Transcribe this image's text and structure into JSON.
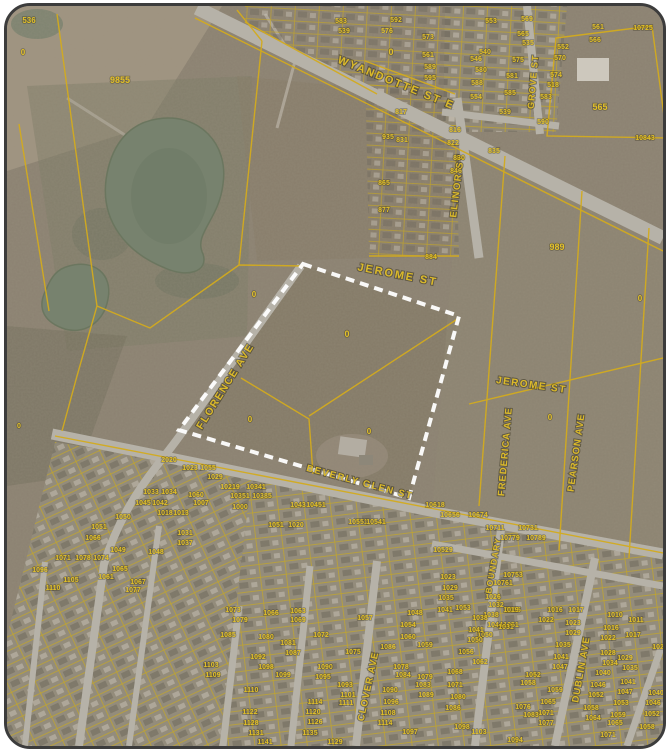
{
  "map": {
    "colors": {
      "base": "#8b8171",
      "parcel_line": "#d3ab1e",
      "label": "#e2c028",
      "street_label": "#dcba2a",
      "selection_boundary": "#ffffff",
      "road": "#b6b2a8",
      "pond": "#77826e",
      "subdivision_ground": "#96907f",
      "frame_border": "#3c3c3c"
    },
    "street_labels": [
      {
        "t": "WYANDOTTE ST E",
        "x": 388,
        "y": 80,
        "a": 22,
        "s": 11,
        "ls": 2
      },
      {
        "t": "ELINOR ST",
        "x": 453,
        "y": 180,
        "a": -83,
        "s": 9.5,
        "ls": 1.5
      },
      {
        "t": "GROVE ST",
        "x": 529,
        "y": 76,
        "a": -85,
        "s": 9,
        "ls": 1
      },
      {
        "t": "JEROME ST",
        "x": 390,
        "y": 272,
        "a": 11,
        "s": 11,
        "ls": 2
      },
      {
        "t": "JEROME ST",
        "x": 524,
        "y": 382,
        "a": 8,
        "s": 10,
        "ls": 1.5
      },
      {
        "t": "FLORENCE AVE",
        "x": 221,
        "y": 382,
        "a": -58,
        "s": 10.5,
        "ls": 1.5
      },
      {
        "t": "FREDERICA AVE",
        "x": 501,
        "y": 446,
        "a": -85,
        "s": 9.5,
        "ls": 1
      },
      {
        "t": "PEARSON AVE",
        "x": 572,
        "y": 447,
        "a": -82,
        "s": 9.5,
        "ls": 1
      },
      {
        "t": "BEVERLY GLEN ST",
        "x": 352,
        "y": 479,
        "a": 15,
        "s": 9.5,
        "ls": 1.5
      },
      {
        "t": "BOUNDARY",
        "x": 489,
        "y": 560,
        "a": -80,
        "s": 8.5,
        "ls": 1
      },
      {
        "t": "CLOVER AVE",
        "x": 364,
        "y": 681,
        "a": -78,
        "s": 9.5,
        "ls": 1
      },
      {
        "t": "DUBLIN AVE",
        "x": 577,
        "y": 664,
        "a": -80,
        "s": 9.5,
        "ls": 1
      }
    ],
    "parcel_labels": [
      {
        "t": "536",
        "x": 22,
        "y": 17,
        "s": 8
      },
      {
        "t": "0",
        "x": 16,
        "y": 49,
        "s": 8
      },
      {
        "t": "9855",
        "x": 113,
        "y": 77,
        "s": 9
      },
      {
        "t": "0",
        "x": 12,
        "y": 422,
        "s": 7
      },
      {
        "t": "0",
        "x": 384,
        "y": 49,
        "s": 9
      },
      {
        "t": "0",
        "x": 340,
        "y": 331,
        "s": 9
      },
      {
        "t": "0",
        "x": 247,
        "y": 291,
        "s": 8
      },
      {
        "t": "0",
        "x": 243,
        "y": 416,
        "s": 8
      },
      {
        "t": "0",
        "x": 362,
        "y": 428,
        "s": 8
      },
      {
        "t": "0",
        "x": 543,
        "y": 414,
        "s": 8
      },
      {
        "t": "0",
        "x": 633,
        "y": 295,
        "s": 8
      },
      {
        "t": "989",
        "x": 550,
        "y": 244,
        "s": 9
      },
      {
        "t": "565",
        "x": 593,
        "y": 104,
        "s": 9
      },
      {
        "t": "583",
        "x": 334,
        "y": 17
      },
      {
        "t": "539",
        "x": 337,
        "y": 27
      },
      {
        "t": "592",
        "x": 389,
        "y": 16
      },
      {
        "t": "576",
        "x": 380,
        "y": 27
      },
      {
        "t": "573",
        "x": 421,
        "y": 33
      },
      {
        "t": "561",
        "x": 421,
        "y": 51
      },
      {
        "t": "589",
        "x": 423,
        "y": 63
      },
      {
        "t": "595",
        "x": 423,
        "y": 74
      },
      {
        "t": "817",
        "x": 394,
        "y": 108
      },
      {
        "t": "831",
        "x": 395,
        "y": 136
      },
      {
        "t": "935",
        "x": 381,
        "y": 133
      },
      {
        "t": "865",
        "x": 377,
        "y": 179
      },
      {
        "t": "877",
        "x": 377,
        "y": 206
      },
      {
        "t": "884",
        "x": 424,
        "y": 253
      },
      {
        "t": "816",
        "x": 448,
        "y": 126
      },
      {
        "t": "822",
        "x": 446,
        "y": 139
      },
      {
        "t": "830",
        "x": 452,
        "y": 154
      },
      {
        "t": "846",
        "x": 449,
        "y": 167
      },
      {
        "t": "835",
        "x": 487,
        "y": 147
      },
      {
        "t": "553",
        "x": 484,
        "y": 17
      },
      {
        "t": "569",
        "x": 520,
        "y": 15
      },
      {
        "t": "561",
        "x": 591,
        "y": 23
      },
      {
        "t": "10725",
        "x": 636,
        "y": 24
      },
      {
        "t": "565",
        "x": 516,
        "y": 30
      },
      {
        "t": "566",
        "x": 588,
        "y": 36
      },
      {
        "t": "535",
        "x": 521,
        "y": 39
      },
      {
        "t": "552",
        "x": 556,
        "y": 43
      },
      {
        "t": "540",
        "x": 478,
        "y": 48
      },
      {
        "t": "575",
        "x": 511,
        "y": 56
      },
      {
        "t": "570",
        "x": 553,
        "y": 54
      },
      {
        "t": "546",
        "x": 469,
        "y": 55
      },
      {
        "t": "581",
        "x": 505,
        "y": 72
      },
      {
        "t": "580",
        "x": 474,
        "y": 66
      },
      {
        "t": "574",
        "x": 549,
        "y": 71
      },
      {
        "t": "588",
        "x": 470,
        "y": 79
      },
      {
        "t": "518",
        "x": 546,
        "y": 81
      },
      {
        "t": "585",
        "x": 503,
        "y": 89
      },
      {
        "t": "583",
        "x": 539,
        "y": 93
      },
      {
        "t": "554",
        "x": 469,
        "y": 93
      },
      {
        "t": "539",
        "x": 498,
        "y": 108
      },
      {
        "t": "590",
        "x": 536,
        "y": 118
      },
      {
        "t": "10843",
        "x": 638,
        "y": 134
      },
      {
        "t": "2020",
        "x": 162,
        "y": 456
      },
      {
        "t": "1023",
        "x": 183,
        "y": 464
      },
      {
        "t": "1055",
        "x": 201,
        "y": 464
      },
      {
        "t": "1029",
        "x": 208,
        "y": 473
      },
      {
        "t": "1033",
        "x": 144,
        "y": 488
      },
      {
        "t": "1034",
        "x": 162,
        "y": 488
      },
      {
        "t": "1060",
        "x": 189,
        "y": 491
      },
      {
        "t": "1007",
        "x": 194,
        "y": 499
      },
      {
        "t": "1045",
        "x": 136,
        "y": 499
      },
      {
        "t": "1042",
        "x": 153,
        "y": 499
      },
      {
        "t": "1018",
        "x": 158,
        "y": 509
      },
      {
        "t": "1013",
        "x": 174,
        "y": 509
      },
      {
        "t": "1050",
        "x": 116,
        "y": 513
      },
      {
        "t": "1051",
        "x": 92,
        "y": 523
      },
      {
        "t": "1031",
        "x": 178,
        "y": 529
      },
      {
        "t": "1066",
        "x": 86,
        "y": 534
      },
      {
        "t": "1037",
        "x": 178,
        "y": 539
      },
      {
        "t": "1049",
        "x": 111,
        "y": 546
      },
      {
        "t": "1048",
        "x": 149,
        "y": 548
      },
      {
        "t": "1071",
        "x": 56,
        "y": 554
      },
      {
        "t": "1078",
        "x": 76,
        "y": 554
      },
      {
        "t": "1074",
        "x": 94,
        "y": 554
      },
      {
        "t": "1096",
        "x": 33,
        "y": 566
      },
      {
        "t": "1065",
        "x": 113,
        "y": 565
      },
      {
        "t": "1061",
        "x": 99,
        "y": 573
      },
      {
        "t": "1105",
        "x": 64,
        "y": 576
      },
      {
        "t": "1067",
        "x": 131,
        "y": 578
      },
      {
        "t": "1110",
        "x": 46,
        "y": 584
      },
      {
        "t": "1077",
        "x": 126,
        "y": 586
      },
      {
        "t": "10219",
        "x": 223,
        "y": 483
      },
      {
        "t": "10341",
        "x": 249,
        "y": 483
      },
      {
        "t": "10351",
        "x": 233,
        "y": 492
      },
      {
        "t": "10385",
        "x": 255,
        "y": 492
      },
      {
        "t": "1000",
        "x": 233,
        "y": 503
      },
      {
        "t": "1043",
        "x": 291,
        "y": 501
      },
      {
        "t": "10451",
        "x": 309,
        "y": 501
      },
      {
        "t": "1051",
        "x": 269,
        "y": 521
      },
      {
        "t": "1020",
        "x": 289,
        "y": 521
      },
      {
        "t": "10551",
        "x": 351,
        "y": 518
      },
      {
        "t": "10541",
        "x": 369,
        "y": 518
      },
      {
        "t": "10618",
        "x": 428,
        "y": 501
      },
      {
        "t": "10656",
        "x": 443,
        "y": 511
      },
      {
        "t": "10674",
        "x": 471,
        "y": 511
      },
      {
        "t": "10711",
        "x": 488,
        "y": 524
      },
      {
        "t": "10731",
        "x": 521,
        "y": 524
      },
      {
        "t": "10779",
        "x": 503,
        "y": 534
      },
      {
        "t": "10789",
        "x": 529,
        "y": 534
      },
      {
        "t": "10529",
        "x": 436,
        "y": 546
      },
      {
        "t": "10753",
        "x": 506,
        "y": 571
      },
      {
        "t": "10761",
        "x": 496,
        "y": 579
      },
      {
        "t": "1023",
        "x": 441,
        "y": 573
      },
      {
        "t": "1029",
        "x": 443,
        "y": 584
      },
      {
        "t": "1035",
        "x": 439,
        "y": 594
      },
      {
        "t": "1041",
        "x": 438,
        "y": 606
      },
      {
        "t": "1026",
        "x": 486,
        "y": 593
      },
      {
        "t": "1032",
        "x": 489,
        "y": 601
      },
      {
        "t": "1038",
        "x": 484,
        "y": 611
      },
      {
        "t": "1044",
        "x": 488,
        "y": 621
      },
      {
        "t": "1050",
        "x": 478,
        "y": 631
      },
      {
        "t": "1015",
        "x": 506,
        "y": 606
      },
      {
        "t": "1051",
        "x": 504,
        "y": 621
      },
      {
        "t": "1073",
        "x": 226,
        "y": 606
      },
      {
        "t": "1066",
        "x": 264,
        "y": 609
      },
      {
        "t": "1063",
        "x": 291,
        "y": 607
      },
      {
        "t": "1069",
        "x": 291,
        "y": 616
      },
      {
        "t": "1057",
        "x": 358,
        "y": 614
      },
      {
        "t": "1048",
        "x": 408,
        "y": 609
      },
      {
        "t": "1054",
        "x": 401,
        "y": 621
      },
      {
        "t": "1079",
        "x": 233,
        "y": 616
      },
      {
        "t": "1085",
        "x": 221,
        "y": 631
      },
      {
        "t": "1080",
        "x": 259,
        "y": 633
      },
      {
        "t": "1081",
        "x": 281,
        "y": 639
      },
      {
        "t": "1087",
        "x": 286,
        "y": 649
      },
      {
        "t": "1060",
        "x": 401,
        "y": 633
      },
      {
        "t": "1059",
        "x": 418,
        "y": 641
      },
      {
        "t": "1072",
        "x": 314,
        "y": 631
      },
      {
        "t": "1075",
        "x": 346,
        "y": 648
      },
      {
        "t": "1086",
        "x": 381,
        "y": 643
      },
      {
        "t": "1092",
        "x": 251,
        "y": 653
      },
      {
        "t": "1098",
        "x": 259,
        "y": 663
      },
      {
        "t": "1099",
        "x": 276,
        "y": 671
      },
      {
        "t": "1103",
        "x": 204,
        "y": 661
      },
      {
        "t": "1109",
        "x": 206,
        "y": 671
      },
      {
        "t": "1090",
        "x": 318,
        "y": 663
      },
      {
        "t": "1095",
        "x": 316,
        "y": 673
      },
      {
        "t": "1093",
        "x": 338,
        "y": 681
      },
      {
        "t": "1101",
        "x": 341,
        "y": 691
      },
      {
        "t": "1111",
        "x": 339,
        "y": 699
      },
      {
        "t": "1110",
        "x": 244,
        "y": 686
      },
      {
        "t": "1114",
        "x": 308,
        "y": 698
      },
      {
        "t": "1120",
        "x": 306,
        "y": 708
      },
      {
        "t": "1122",
        "x": 243,
        "y": 708
      },
      {
        "t": "1126",
        "x": 308,
        "y": 718
      },
      {
        "t": "1128",
        "x": 244,
        "y": 719
      },
      {
        "t": "1131",
        "x": 249,
        "y": 729
      },
      {
        "t": "1141",
        "x": 258,
        "y": 738
      },
      {
        "t": "1129",
        "x": 328,
        "y": 738
      },
      {
        "t": "1135",
        "x": 303,
        "y": 729
      },
      {
        "t": "1084",
        "x": 396,
        "y": 671
      },
      {
        "t": "1078",
        "x": 394,
        "y": 663
      },
      {
        "t": "1090",
        "x": 383,
        "y": 686
      },
      {
        "t": "1096",
        "x": 384,
        "y": 698
      },
      {
        "t": "1108",
        "x": 381,
        "y": 709
      },
      {
        "t": "1114",
        "x": 378,
        "y": 719
      },
      {
        "t": "1097",
        "x": 403,
        "y": 728
      },
      {
        "t": "1079",
        "x": 418,
        "y": 673
      },
      {
        "t": "1083",
        "x": 416,
        "y": 681
      },
      {
        "t": "1089",
        "x": 419,
        "y": 691
      },
      {
        "t": "1053",
        "x": 456,
        "y": 604
      },
      {
        "t": "1019",
        "x": 504,
        "y": 606
      },
      {
        "t": "1016",
        "x": 548,
        "y": 606
      },
      {
        "t": "1017",
        "x": 569,
        "y": 606
      },
      {
        "t": "1038",
        "x": 473,
        "y": 614
      },
      {
        "t": "1022",
        "x": 539,
        "y": 616
      },
      {
        "t": "1023",
        "x": 566,
        "y": 619
      },
      {
        "t": "1031",
        "x": 499,
        "y": 623
      },
      {
        "t": "1041",
        "x": 469,
        "y": 626
      },
      {
        "t": "1029",
        "x": 566,
        "y": 629
      },
      {
        "t": "1050",
        "x": 468,
        "y": 636
      },
      {
        "t": "1035",
        "x": 556,
        "y": 641
      },
      {
        "t": "1056",
        "x": 459,
        "y": 648
      },
      {
        "t": "1041",
        "x": 554,
        "y": 653
      },
      {
        "t": "1047",
        "x": 553,
        "y": 663
      },
      {
        "t": "1062",
        "x": 473,
        "y": 658
      },
      {
        "t": "1052",
        "x": 526,
        "y": 671
      },
      {
        "t": "1068",
        "x": 448,
        "y": 668
      },
      {
        "t": "1058",
        "x": 521,
        "y": 679
      },
      {
        "t": "1059",
        "x": 548,
        "y": 686
      },
      {
        "t": "1071",
        "x": 448,
        "y": 681
      },
      {
        "t": "1065",
        "x": 541,
        "y": 698
      },
      {
        "t": "1076",
        "x": 516,
        "y": 703
      },
      {
        "t": "1071",
        "x": 539,
        "y": 709
      },
      {
        "t": "1080",
        "x": 451,
        "y": 693
      },
      {
        "t": "1086",
        "x": 446,
        "y": 704
      },
      {
        "t": "1077",
        "x": 539,
        "y": 719
      },
      {
        "t": "1083",
        "x": 524,
        "y": 711
      },
      {
        "t": "1094",
        "x": 508,
        "y": 736
      },
      {
        "t": "1103",
        "x": 472,
        "y": 728
      },
      {
        "t": "1098",
        "x": 455,
        "y": 723
      },
      {
        "t": "1010",
        "x": 608,
        "y": 611
      },
      {
        "t": "1011",
        "x": 629,
        "y": 616
      },
      {
        "t": "1016",
        "x": 604,
        "y": 624
      },
      {
        "t": "1017",
        "x": 626,
        "y": 631
      },
      {
        "t": "1022",
        "x": 601,
        "y": 634
      },
      {
        "t": "1023",
        "x": 653,
        "y": 643
      },
      {
        "t": "1028",
        "x": 601,
        "y": 649
      },
      {
        "t": "1029",
        "x": 618,
        "y": 654
      },
      {
        "t": "1034",
        "x": 603,
        "y": 659
      },
      {
        "t": "1035",
        "x": 623,
        "y": 664
      },
      {
        "t": "1040",
        "x": 596,
        "y": 669
      },
      {
        "t": "1041",
        "x": 621,
        "y": 678
      },
      {
        "t": "1046",
        "x": 591,
        "y": 681
      },
      {
        "t": "1047",
        "x": 618,
        "y": 688
      },
      {
        "t": "1052",
        "x": 589,
        "y": 691
      },
      {
        "t": "1053",
        "x": 614,
        "y": 699
      },
      {
        "t": "1058",
        "x": 584,
        "y": 704
      },
      {
        "t": "1059",
        "x": 611,
        "y": 711
      },
      {
        "t": "1064",
        "x": 586,
        "y": 714
      },
      {
        "t": "1065",
        "x": 608,
        "y": 719
      },
      {
        "t": "1071",
        "x": 601,
        "y": 731
      },
      {
        "t": "1040",
        "x": 649,
        "y": 689
      },
      {
        "t": "1046",
        "x": 646,
        "y": 699
      },
      {
        "t": "1052",
        "x": 645,
        "y": 710
      },
      {
        "t": "1058",
        "x": 640,
        "y": 723
      }
    ]
  }
}
